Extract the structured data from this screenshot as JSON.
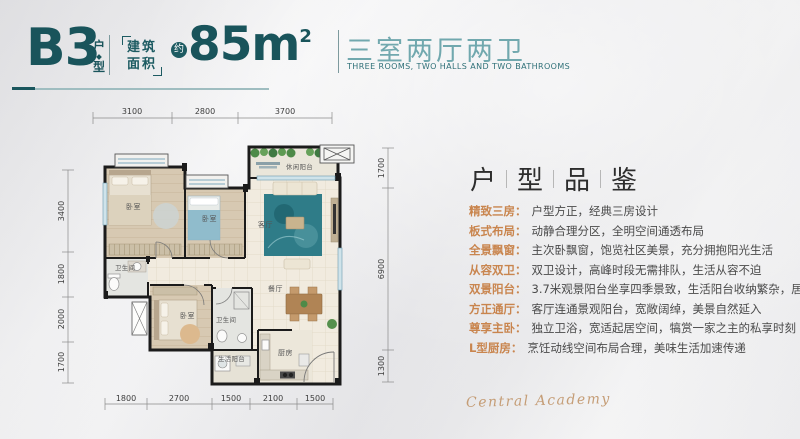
{
  "header": {
    "unit_code": "B3",
    "unit_label_top": "户",
    "unit_label_bottom": "型",
    "area_label_line1": "建筑",
    "area_label_line2": "面积",
    "area_badge": "约",
    "area_value": "85m",
    "area_sup": "2",
    "title_cn": "三室两厅两卫",
    "title_en": "THREE ROOMS, TWO HALLS AND TWO BATHROOMS"
  },
  "floorplan": {
    "dims_top": [
      "3100",
      "2800",
      "3700"
    ],
    "dims_left": [
      "3400",
      "1800",
      "2000",
      "1700"
    ],
    "dims_right": [
      "1700",
      "6900",
      "1300"
    ],
    "dims_bottom": [
      "1800",
      "2700",
      "1500",
      "2100",
      "1500"
    ],
    "rooms": {
      "bedroom1": "卧室",
      "bedroom2": "卧室",
      "leisure_balcony": "休闲阳台",
      "living": "客厅",
      "dining": "餐厅",
      "bath1": "卫生间",
      "bedroom3": "卧室",
      "bath2": "卫生间",
      "life_balcony": "生活阳台",
      "kitchen": "厨房"
    }
  },
  "panel": {
    "heading": [
      "户",
      "型",
      "品",
      "鉴"
    ],
    "features": [
      {
        "tag": "精致三房：",
        "desc": "户型方正，经典三房设计"
      },
      {
        "tag": "板式布局：",
        "desc": "动静合理分区，全明空间通透布局"
      },
      {
        "tag": "全景飘窗：",
        "desc": "主次卧飘窗，饱览社区美景，充分拥抱阳光生活"
      },
      {
        "tag": "从容双卫：",
        "desc": "双卫设计，高峰时段无需排队，生活从容不迫"
      },
      {
        "tag": "双景阳台：",
        "desc": "3.7米观景阳台坐享四季景致，生活阳台收纳繁杂，居家更品质"
      },
      {
        "tag": "方正通厅：",
        "desc": "客厅连通景观阳台，宽敞阔绰，美景自然延入"
      },
      {
        "tag": "尊享主卧：",
        "desc": "独立卫浴，宽适起居空间，犒赏一家之主的私享时刻"
      },
      {
        "tag": "L型厨房：",
        "desc": "烹饪动线空间布局合理，美味生活加速传递"
      }
    ],
    "signature": "Central Academy"
  },
  "colors": {
    "teal_dark": "#19545b",
    "teal_light": "#71a8ae",
    "tag_orange": "#c9854e",
    "signature_gold": "#c59d76"
  }
}
